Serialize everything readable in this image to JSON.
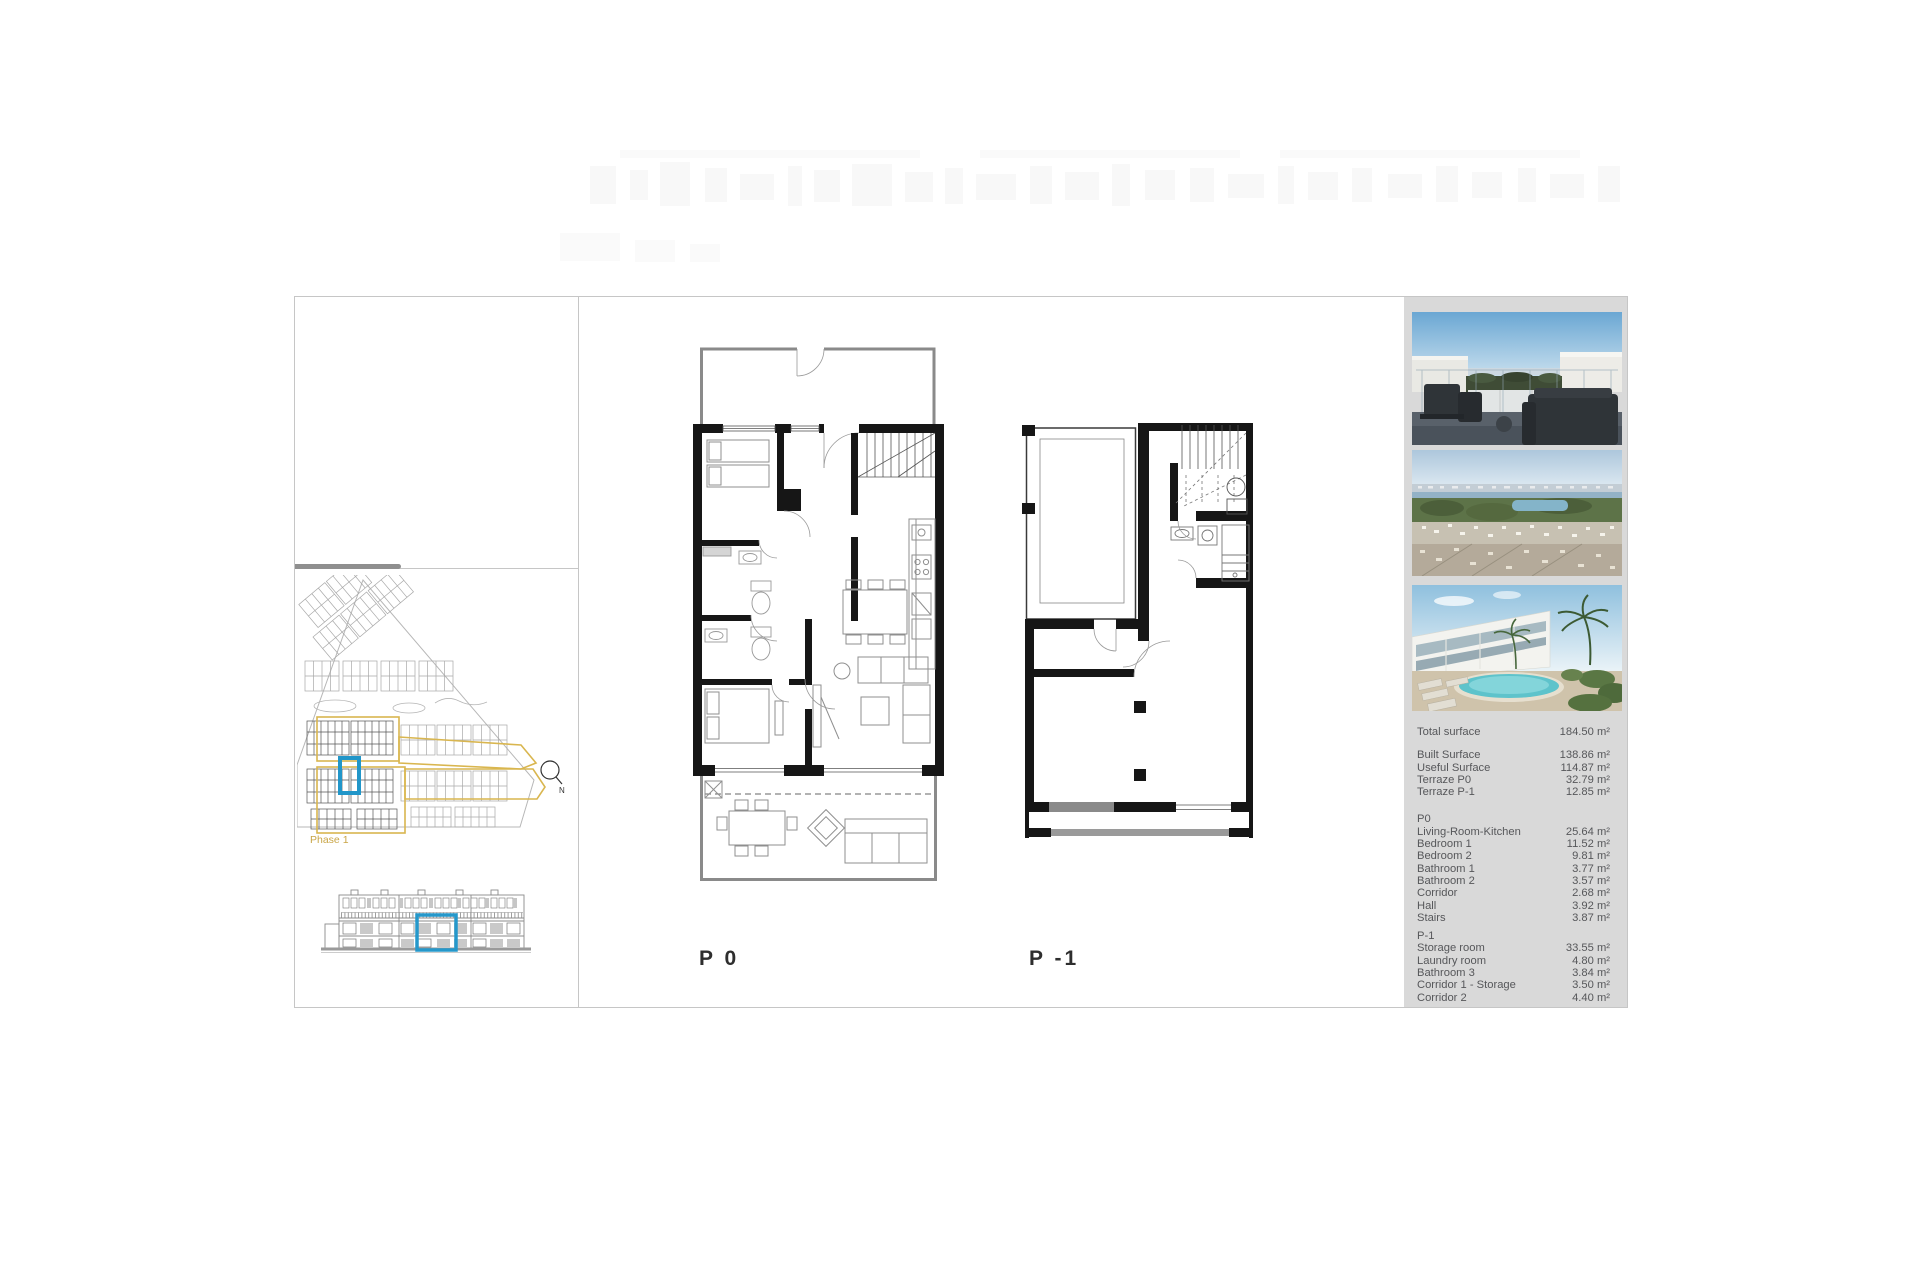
{
  "floor_labels": {
    "p0": "P 0",
    "p_minus_1": "P -1"
  },
  "site_plan": {
    "phase_label": "Phase 1",
    "compass_label": "N"
  },
  "photos": [
    {
      "name": "terrace-lounge-render"
    },
    {
      "name": "aerial-coastline-view"
    },
    {
      "name": "pool-and-townhouses-render"
    }
  ],
  "summary": {
    "total": {
      "label": "Total surface",
      "value": "184.50 m²"
    },
    "rows": [
      {
        "label": "Built Surface",
        "value": "138.86 m²"
      },
      {
        "label": "Useful Surface",
        "value": "114.87 m²"
      },
      {
        "label": "Terraze P0",
        "value": "32.79 m²"
      },
      {
        "label": "Terraze P-1",
        "value": "12.85 m²"
      }
    ]
  },
  "p0_section": {
    "title": "P0",
    "rows": [
      {
        "label": "Living-Room-Kitchen",
        "value": "25.64 m²"
      },
      {
        "label": "Bedroom 1",
        "value": "11.52 m²"
      },
      {
        "label": "Bedroom 2",
        "value": "9.81 m²"
      },
      {
        "label": "Bathroom 1",
        "value": "3.77 m²"
      },
      {
        "label": "Bathroom 2",
        "value": "3.57 m²"
      },
      {
        "label": "Corridor",
        "value": "2.68 m²"
      },
      {
        "label": "Hall",
        "value": "3.92 m²"
      },
      {
        "label": "Stairs",
        "value": "3.87 m²"
      }
    ]
  },
  "pm1_section": {
    "title": "P-1",
    "rows": [
      {
        "label": "Storage room",
        "value": "33.55 m²"
      },
      {
        "label": "Laundry room",
        "value": "4.80 m²"
      },
      {
        "label": "Bathroom 3",
        "value": "3.84 m²"
      },
      {
        "label": "Corridor 1 - Storage",
        "value": "3.50 m²"
      },
      {
        "label": "Corridor 2",
        "value": "4.40 m²"
      }
    ]
  },
  "colors": {
    "highlight_blue": "#2196c9",
    "phase_gold": "#d5b150",
    "panel_gray": "#d9d9d9",
    "wall_black": "#161616"
  }
}
